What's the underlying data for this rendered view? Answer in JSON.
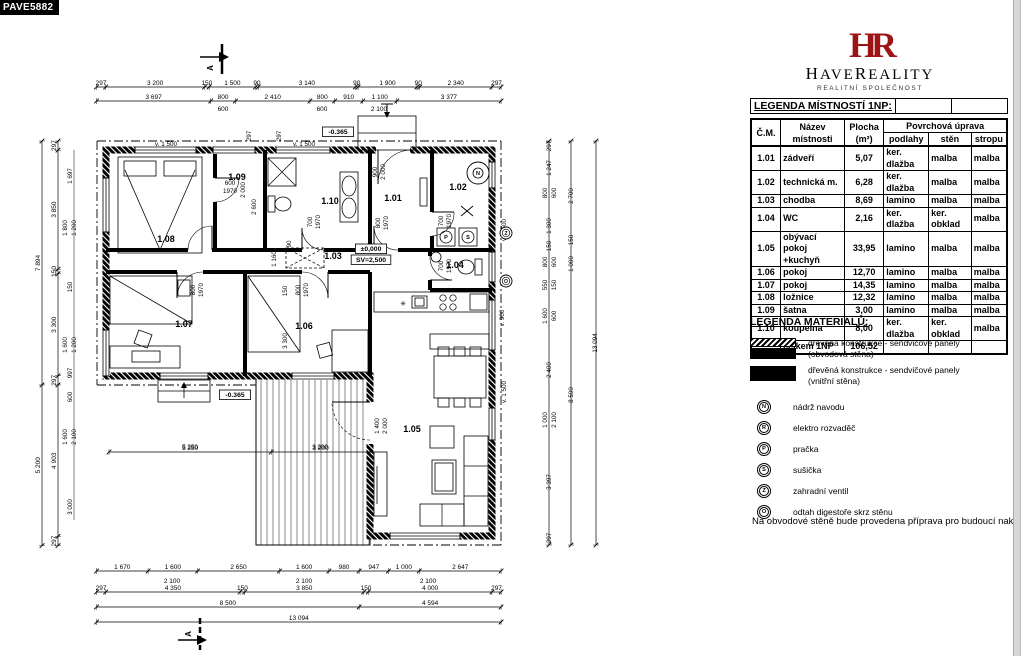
{
  "page": {
    "corner_label": "PAVE5882"
  },
  "logo": {
    "monogram": "HR",
    "name_parts": [
      "H",
      "AVE",
      "R",
      "EALITY"
    ],
    "subtitle": "REALITNÍ SPOLEČNOST",
    "brand_color": "#9c1414"
  },
  "room_legend": {
    "title": "LEGENDA MÍSTNOSTÍ 1NP:",
    "columns": {
      "num": "Č.M.",
      "name1": "Název",
      "name2": "místnosti",
      "area1": "Plocha",
      "area2": "(m²)",
      "surface": "Povrchová úprava",
      "floor": "podlahy",
      "wall": "stěn",
      "ceiling": "stropu"
    },
    "rows": [
      {
        "num": "1.01",
        "name": "zádveří",
        "area": "5,07",
        "floor": "ker. dlažba",
        "wall": "malba",
        "ceiling": "malba"
      },
      {
        "num": "1.02",
        "name": "technická m.",
        "area": "6,28",
        "floor": "ker. dlažba",
        "wall": "malba",
        "ceiling": "malba"
      },
      {
        "num": "1.03",
        "name": "chodba",
        "area": "8,69",
        "floor": "lamino",
        "wall": "malba",
        "ceiling": "malba"
      },
      {
        "num": "1.04",
        "name": "WC",
        "area": "2,16",
        "floor": "ker. dlažba",
        "wall": "ker. obklad",
        "ceiling": "malba"
      },
      {
        "num": "1.05",
        "name": "obývací pokoj +kuchyň",
        "area": "33,95",
        "floor": "lamino",
        "wall": "malba",
        "ceiling": "malba"
      },
      {
        "num": "1.06",
        "name": "pokoj",
        "area": "12,70",
        "floor": "lamino",
        "wall": "malba",
        "ceiling": "malba"
      },
      {
        "num": "1.07",
        "name": "pokoj",
        "area": "14,35",
        "floor": "lamino",
        "wall": "malba",
        "ceiling": "malba"
      },
      {
        "num": "1.08",
        "name": "ložnice",
        "area": "12,32",
        "floor": "lamino",
        "wall": "malba",
        "ceiling": "malba"
      },
      {
        "num": "1.09",
        "name": "šatna",
        "area": "3,00",
        "floor": "lamino",
        "wall": "malba",
        "ceiling": "malba"
      },
      {
        "num": "1.10",
        "name": "koupelna",
        "area": "8,00",
        "floor": "ker. dlažba",
        "wall": "ker. obklad",
        "ceiling": "malba"
      }
    ],
    "total": {
      "label": "celkem 1NP",
      "value": "106,52"
    }
  },
  "materials_legend": {
    "title": "LEGENDA MATERIÁLŮ:",
    "items": [
      {
        "swatch": "exterior-wall",
        "line1": "dřevěná konstrukce - sendvičové panely",
        "line2": "(obvodová stěna)"
      },
      {
        "swatch": "interior-wall",
        "line1": "dřevěná konstrukce - sendvičové panely",
        "line2": "(vnitřní stěna)"
      }
    ]
  },
  "symbol_legend": [
    {
      "letter": "N",
      "label": "nádrž navodu"
    },
    {
      "letter": "R",
      "label": "elektro rozvaděč"
    },
    {
      "letter": "P",
      "label": "pračka"
    },
    {
      "letter": "S",
      "label": "sušička"
    },
    {
      "letter": "Z",
      "label": "zahradní ventil"
    },
    {
      "letter": "O",
      "label": "odtah digestoře skrz stěnu"
    }
  ],
  "note": "Na obvodové stěně bude provedena příprava pro budoucí nakot",
  "plan": {
    "section_label": "A",
    "rooms": [
      {
        "id": "1.01",
        "x": 393,
        "y": 201
      },
      {
        "id": "1.02",
        "x": 458,
        "y": 190
      },
      {
        "id": "1.03",
        "x": 333,
        "y": 259
      },
      {
        "id": "1.04",
        "x": 455,
        "y": 268
      },
      {
        "id": "1.05",
        "x": 412,
        "y": 432
      },
      {
        "id": "1.06",
        "x": 304,
        "y": 329
      },
      {
        "id": "1.07",
        "x": 184,
        "y": 327
      },
      {
        "id": "1.08",
        "x": 166,
        "y": 242
      },
      {
        "id": "1.09",
        "x": 237,
        "y": 180
      },
      {
        "id": "1.10",
        "x": 330,
        "y": 204
      }
    ],
    "dim_chains": [
      {
        "dir": "h",
        "x": 96.5,
        "y": 87,
        "segs": [
          "297",
          "3 200",
          "150",
          "1 500",
          "90",
          "3 140",
          "90",
          "1 900",
          "90",
          "2 340",
          "297"
        ]
      },
      {
        "dir": "h",
        "x": 96.5,
        "y": 101,
        "segs": [
          "3 697",
          "800",
          "2 410",
          "800",
          "910",
          "1 100",
          "3 377"
        ]
      },
      {
        "dir": "h",
        "x": 96.5,
        "y": 571,
        "segs": [
          "1 670",
          "1 600",
          "2 650",
          "1 600",
          "980",
          "947",
          "1 000",
          "2 647"
        ]
      },
      {
        "dir": "h",
        "x": 96.5,
        "y": 592,
        "segs": [
          "297",
          "4 350",
          "150",
          "3 850",
          "150",
          "4 000",
          "297"
        ]
      },
      {
        "dir": "h",
        "x": 96.5,
        "y": 607,
        "segs": [
          "8 500",
          "4 594"
        ]
      },
      {
        "dir": "h",
        "x": 96.5,
        "y": 622,
        "segs": [
          "13 094"
        ]
      },
      {
        "dir": "h",
        "x": 109,
        "y": 452,
        "segs": [
          "5 250",
          "3 200"
        ]
      },
      {
        "dir": "v",
        "x": 42,
        "y": 141,
        "segs": [
          "7 894",
          "5 200"
        ]
      },
      {
        "dir": "v",
        "x": 58,
        "y": 141,
        "segs": [
          "297",
          "3 850",
          "150",
          "3 300",
          "297",
          "4 903",
          "297"
        ]
      }
    ],
    "sub_dims": [
      {
        "t": "600",
        "x": 223,
        "y": 111
      },
      {
        "t": "600",
        "x": 322,
        "y": 111
      },
      {
        "t": "2 100",
        "x": 379,
        "y": 111
      },
      {
        "t": "2 100",
        "x": 172,
        "y": 583
      },
      {
        "t": "2 100",
        "x": 304,
        "y": 583
      },
      {
        "t": "2 100",
        "x": 428,
        "y": 583
      }
    ],
    "annotations": [
      {
        "t": "v. 1 500",
        "x": 166,
        "y": 146
      },
      {
        "t": "v. 1 500",
        "x": 304,
        "y": 146
      },
      {
        "t": "297",
        "x": 251,
        "y": 136,
        "rot": true
      },
      {
        "t": "297",
        "x": 281,
        "y": 136,
        "rot": true
      },
      {
        "t": "-0.365",
        "x": 338,
        "y": 134,
        "box": true
      },
      {
        "t": "600",
        "x": 230,
        "y": 185
      },
      {
        "t": "1970",
        "x": 230,
        "y": 193
      },
      {
        "t": "2 000",
        "x": 245,
        "y": 190,
        "rot": true
      },
      {
        "t": "2 600",
        "x": 256,
        "y": 207,
        "rot": true
      },
      {
        "t": "900",
        "x": 377,
        "y": 172,
        "rot": true
      },
      {
        "t": "2 000",
        "x": 385,
        "y": 172,
        "rot": true
      },
      {
        "t": "800",
        "x": 380,
        "y": 223,
        "rot": true
      },
      {
        "t": "1970",
        "x": 388,
        "y": 223,
        "rot": true
      },
      {
        "t": "700",
        "x": 312,
        "y": 222,
        "rot": true
      },
      {
        "t": "1970",
        "x": 320,
        "y": 222,
        "rot": true
      },
      {
        "t": "700",
        "x": 443,
        "y": 221,
        "rot": true
      },
      {
        "t": "1970",
        "x": 451,
        "y": 221,
        "rot": true
      },
      {
        "t": "700",
        "x": 443,
        "y": 266,
        "rot": true
      },
      {
        "t": "1970",
        "x": 451,
        "y": 266,
        "rot": true
      },
      {
        "t": "800",
        "x": 195,
        "y": 290,
        "rot": true
      },
      {
        "t": "1970",
        "x": 203,
        "y": 290,
        "rot": true
      },
      {
        "t": "800",
        "x": 300,
        "y": 290,
        "rot": true
      },
      {
        "t": "1970",
        "x": 308,
        "y": 290,
        "rot": true
      },
      {
        "t": "1 160",
        "x": 276,
        "y": 259,
        "rot": true
      },
      {
        "t": "90",
        "x": 291,
        "y": 244,
        "rot": true
      },
      {
        "t": "±0,000",
        "x": 371,
        "y": 251,
        "box": true
      },
      {
        "t": "SV=2,500",
        "x": 371,
        "y": 262,
        "box": true
      },
      {
        "t": "150",
        "x": 287,
        "y": 291,
        "rot": true
      },
      {
        "t": "3 300",
        "x": 287,
        "y": 341,
        "rot": true
      },
      {
        "t": "-0.365",
        "x": 235,
        "y": 397,
        "box": true
      },
      {
        "t": "1 400",
        "x": 379,
        "y": 426,
        "rot": true
      },
      {
        "t": "2 000",
        "x": 387,
        "y": 426,
        "rot": true
      },
      {
        "t": "v. 1 500",
        "x": 506,
        "y": 230,
        "rot": true
      },
      {
        "t": "v. 900",
        "x": 504,
        "y": 318,
        "rot": true
      },
      {
        "t": "v. 1 500",
        "x": 506,
        "y": 392,
        "rot": true
      },
      {
        "t": "5 250",
        "x": 190,
        "y": 449
      },
      {
        "t": "3 200",
        "x": 320,
        "y": 449
      },
      {
        "t": "1 697",
        "x": 72,
        "y": 176,
        "rot": true
      },
      {
        "t": "1 800",
        "x": 67,
        "y": 228,
        "rot": true
      },
      {
        "t": "1 200",
        "x": 76,
        "y": 228,
        "rot": true
      },
      {
        "t": "150",
        "x": 72,
        "y": 287,
        "rot": true
      },
      {
        "t": "1 600",
        "x": 67,
        "y": 345,
        "rot": true
      },
      {
        "t": "1 200",
        "x": 76,
        "y": 345,
        "rot": true
      },
      {
        "t": "997",
        "x": 72,
        "y": 373,
        "rot": true
      },
      {
        "t": "600",
        "x": 72,
        "y": 397,
        "rot": true
      },
      {
        "t": "1 600",
        "x": 67,
        "y": 437,
        "rot": true
      },
      {
        "t": "2 100",
        "x": 76,
        "y": 437,
        "rot": true
      },
      {
        "t": "3 000",
        "x": 72,
        "y": 507,
        "rot": true
      },
      {
        "t": "297",
        "x": 551,
        "y": 146,
        "rot": true
      },
      {
        "t": "1 247",
        "x": 551,
        "y": 168,
        "rot": true
      },
      {
        "t": "800",
        "x": 547,
        "y": 193,
        "rot": true
      },
      {
        "t": "600",
        "x": 556,
        "y": 193,
        "rot": true
      },
      {
        "t": "2 700",
        "x": 573,
        "y": 196,
        "rot": true
      },
      {
        "t": "1 300",
        "x": 551,
        "y": 226,
        "rot": true
      },
      {
        "t": "150",
        "x": 551,
        "y": 246,
        "rot": true
      },
      {
        "t": "150",
        "x": 573,
        "y": 240,
        "rot": true
      },
      {
        "t": "800",
        "x": 547,
        "y": 262,
        "rot": true
      },
      {
        "t": "600",
        "x": 556,
        "y": 262,
        "rot": true
      },
      {
        "t": "1 000",
        "x": 573,
        "y": 264,
        "rot": true
      },
      {
        "t": "550",
        "x": 547,
        "y": 285,
        "rot": true
      },
      {
        "t": "150",
        "x": 556,
        "y": 285,
        "rot": true
      },
      {
        "t": "1 600",
        "x": 547,
        "y": 316,
        "rot": true
      },
      {
        "t": "600",
        "x": 556,
        "y": 316,
        "rot": true
      },
      {
        "t": "2 400",
        "x": 551,
        "y": 370,
        "rot": true
      },
      {
        "t": "8 500",
        "x": 573,
        "y": 395,
        "rot": true
      },
      {
        "t": "1 000",
        "x": 547,
        "y": 420,
        "rot": true
      },
      {
        "t": "2 100",
        "x": 556,
        "y": 420,
        "rot": true
      },
      {
        "t": "3 397",
        "x": 551,
        "y": 482,
        "rot": true
      },
      {
        "t": "297",
        "x": 551,
        "y": 538,
        "rot": true
      },
      {
        "t": "13 094",
        "x": 597,
        "y": 343,
        "rot": true
      }
    ],
    "wall_symbols": [
      {
        "letter": "N",
        "x": 478,
        "y": 173,
        "style": "double"
      },
      {
        "letter": "P",
        "x": 446,
        "y": 237,
        "style": "boxed"
      },
      {
        "letter": "S",
        "x": 468,
        "y": 237,
        "style": "boxed"
      },
      {
        "letter": "Z",
        "x": 506,
        "y": 233,
        "style": "circle"
      },
      {
        "letter": "O",
        "x": 506,
        "y": 281,
        "style": "circle"
      }
    ]
  }
}
